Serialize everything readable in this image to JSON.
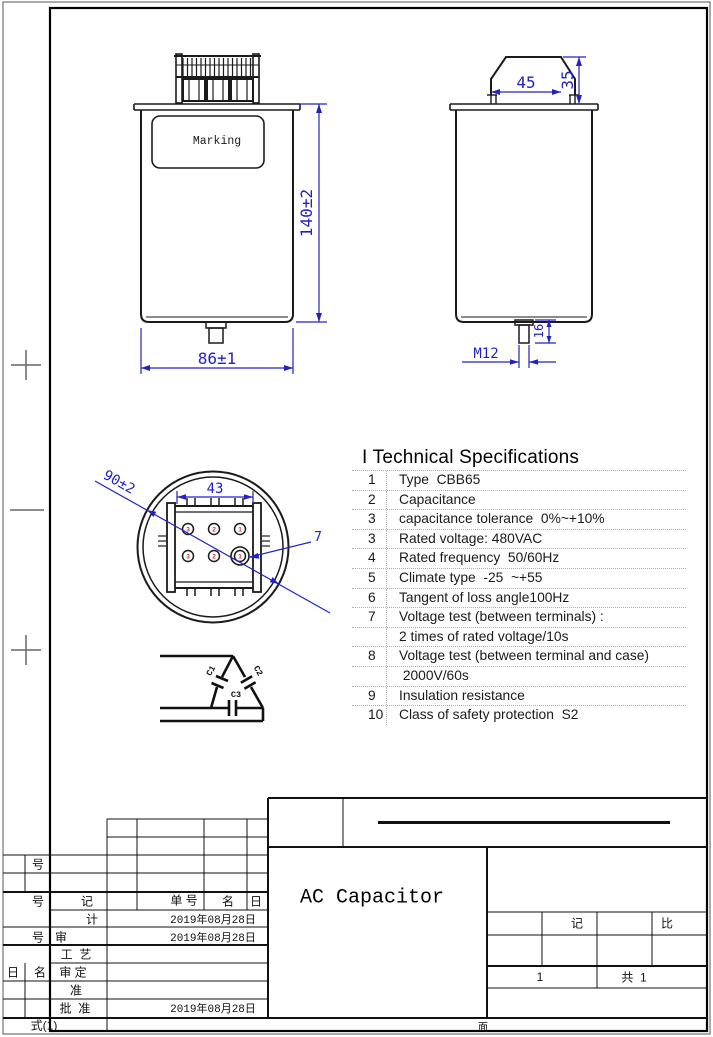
{
  "colors": {
    "dimension": "#2222c4",
    "line": "#1a1a1a",
    "terminal_number": "#cc3333"
  },
  "drawing": {
    "front": {
      "marking": "Marking",
      "height_dim": "140±2",
      "width_dim": "86±1"
    },
    "side": {
      "top_width_dim": "45",
      "top_height_dim": "35",
      "stud_thread": "M12",
      "stud_len_dim": "16"
    },
    "top": {
      "diameter_dim": "90±2",
      "span_dim": "43",
      "hole_dim": "7",
      "terminal_numbers": [
        "3",
        "2",
        "1",
        "3",
        "2",
        "1"
      ]
    },
    "schematic": {
      "c1": "C1",
      "c2": "C2",
      "c3": "C3"
    }
  },
  "specs": {
    "title": "I Technical Specifications",
    "rows": [
      {
        "no": "1",
        "text": "Type  CBB65"
      },
      {
        "no": "2",
        "text": "Capacitance"
      },
      {
        "no": "3",
        "text": "capacitance tolerance  0%~+10%"
      },
      {
        "no": "3",
        "text": "Rated voltage: 480VAC"
      },
      {
        "no": "4",
        "text": "Rated frequency  50/60Hz"
      },
      {
        "no": "5",
        "text": "Climate type  -25  ~+55"
      },
      {
        "no": "6",
        "text": "Tangent of loss angle100Hz"
      },
      {
        "no": "7",
        "text": "Voltage test (between terminals) :"
      },
      {
        "no": "",
        "text": "2 times of rated voltage/10s"
      },
      {
        "no": "8",
        "text": "Voltage test (between terminal and case)"
      },
      {
        "no": "",
        "text": " 2000V/60s"
      },
      {
        "no": "9",
        "text": "Insulation resistance"
      },
      {
        "no": "10",
        "text": "Class of safety protection  S2"
      }
    ]
  },
  "title_block": {
    "product_name": "AC Capacitor",
    "labels": {
      "hao_top": "号",
      "hao_header": "号",
      "ji_mark": "记",
      "dan_hao": "单 号",
      "ming": "名",
      "ri": "日",
      "ji_design": "计",
      "hao_mid": "号",
      "shen": "审",
      "gong_yi": "工  艺",
      "ri2": "日",
      "ming2": "名",
      "shen_ding": "审 定",
      "zhun": "准",
      "pi_zhun": "批  准",
      "shi_1": "式(1)",
      "ji_mark2": "记",
      "bi": "比",
      "page_no": "1",
      "sheet_total": "共  1",
      "mian": "面"
    },
    "dates": {
      "design": "2019年08月28日",
      "check": "2019年08月28日",
      "approve": "2019年08月28日"
    }
  }
}
